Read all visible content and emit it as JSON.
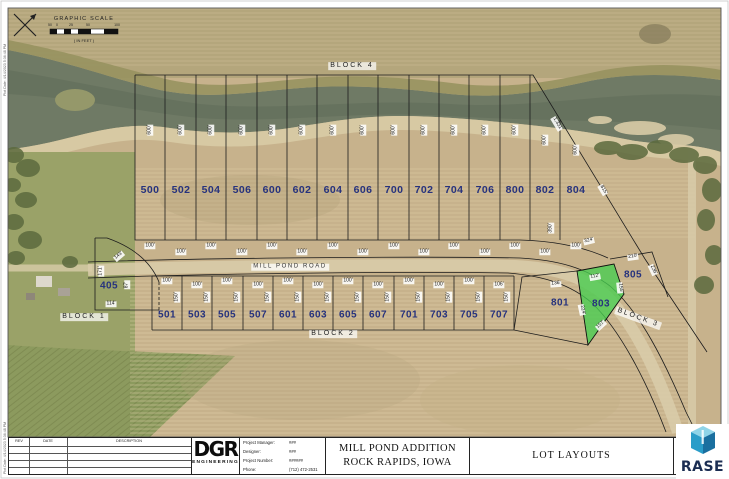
{
  "sheet": {
    "margin_note_top": "Plot Date: 4/14/2023 5:36:48 PM",
    "margin_note_bottom": "Plot Date: 4/14/2023 5:36:48 PM"
  },
  "scale": {
    "title": "GRAPHIC SCALE",
    "in_feet": "( IN FEET )",
    "ticks": [
      "50",
      "0",
      "25",
      "50",
      "100"
    ]
  },
  "road": {
    "name": "MILL POND ROAD"
  },
  "blocks": {
    "block1": "BLOCK 1",
    "block2": "BLOCK 2",
    "block3": "BLOCK 3",
    "block4": "BLOCK 4"
  },
  "lots_top": [
    {
      "n": "500",
      "depth": "600'",
      "width": "100'"
    },
    {
      "n": "502",
      "depth": "600'",
      "width": "100'"
    },
    {
      "n": "504",
      "depth": "600'",
      "width": "100'"
    },
    {
      "n": "506",
      "depth": "600'",
      "width": "100'"
    },
    {
      "n": "600",
      "depth": "600'",
      "width": "100'"
    },
    {
      "n": "602",
      "depth": "600'",
      "width": "100'"
    },
    {
      "n": "604",
      "depth": "600'",
      "width": "100'"
    },
    {
      "n": "606",
      "depth": "600'",
      "width": "100'"
    },
    {
      "n": "700",
      "depth": "600'",
      "width": "100'"
    },
    {
      "n": "702",
      "depth": "600'",
      "width": "100'"
    },
    {
      "n": "704",
      "depth": "600'",
      "width": "100'"
    },
    {
      "n": "706",
      "depth": "600'",
      "width": "100'"
    },
    {
      "n": "800",
      "depth": "600'",
      "width": "100'"
    },
    {
      "n": "802",
      "depth": "600'",
      "width": "100'"
    },
    {
      "n": "804",
      "depth": "600'",
      "width": "100'"
    }
  ],
  "lots_bottom": [
    {
      "n": "501",
      "width": "100'",
      "depth": "150'"
    },
    {
      "n": "503",
      "width": "100'",
      "depth": "150'"
    },
    {
      "n": "505",
      "width": "100'",
      "depth": "150'"
    },
    {
      "n": "507",
      "width": "100'",
      "depth": "150'"
    },
    {
      "n": "601",
      "width": "100'",
      "depth": "150'"
    },
    {
      "n": "603",
      "width": "100'",
      "depth": "150'"
    },
    {
      "n": "605",
      "width": "100'",
      "depth": "150'"
    },
    {
      "n": "607",
      "width": "100'",
      "depth": "150'"
    },
    {
      "n": "701",
      "width": "100'",
      "depth": "150'"
    },
    {
      "n": "703",
      "width": "100'",
      "depth": "150'"
    },
    {
      "n": "705",
      "width": "100'",
      "depth": "150'"
    },
    {
      "n": "707",
      "width": "106'",
      "depth": "150'"
    }
  ],
  "lot405": {
    "n": "405",
    "d1": "143'",
    "d2": "171'",
    "d3": "87'",
    "d4": "114'"
  },
  "lot801": {
    "n": "801",
    "width": "136'"
  },
  "lot803": {
    "n": "803",
    "d_top": "112'",
    "d_left": "224'",
    "d_bottom": "157'",
    "d_right": "155'"
  },
  "lot805": {
    "n": "805",
    "d_top": "210'",
    "d_right": "236'"
  },
  "dims": {
    "d390": "390'",
    "d324": "324'",
    "d_diag_top": "1,331'",
    "d_diag_mid": "815'"
  },
  "titleblock": {
    "rev_header": "REV",
    "date_header": "DATE",
    "desc_header": "DESCRIPTION",
    "logo_main": "DGR",
    "logo_sub": "ENGINEERING",
    "info": [
      {
        "label": "Project Manager:",
        "value": "###"
      },
      {
        "label": "Designer:",
        "value": "###"
      },
      {
        "label": "Project Number:",
        "value": "######"
      },
      {
        "label": "Phone:",
        "value": "(712) 472-2531"
      }
    ],
    "project_title_1": "MILL POND ADDITION",
    "project_title_2": "ROCK RAPIDS, IOWA",
    "sheet_title": "LOT LAYOUTS",
    "sheet_word": "SHEET",
    "rase_text": "RASE"
  },
  "colors": {
    "lot_number": "#26327d",
    "highlight_green": "#46cd50",
    "water": "#6f7a65",
    "field": "#c7b28c"
  }
}
